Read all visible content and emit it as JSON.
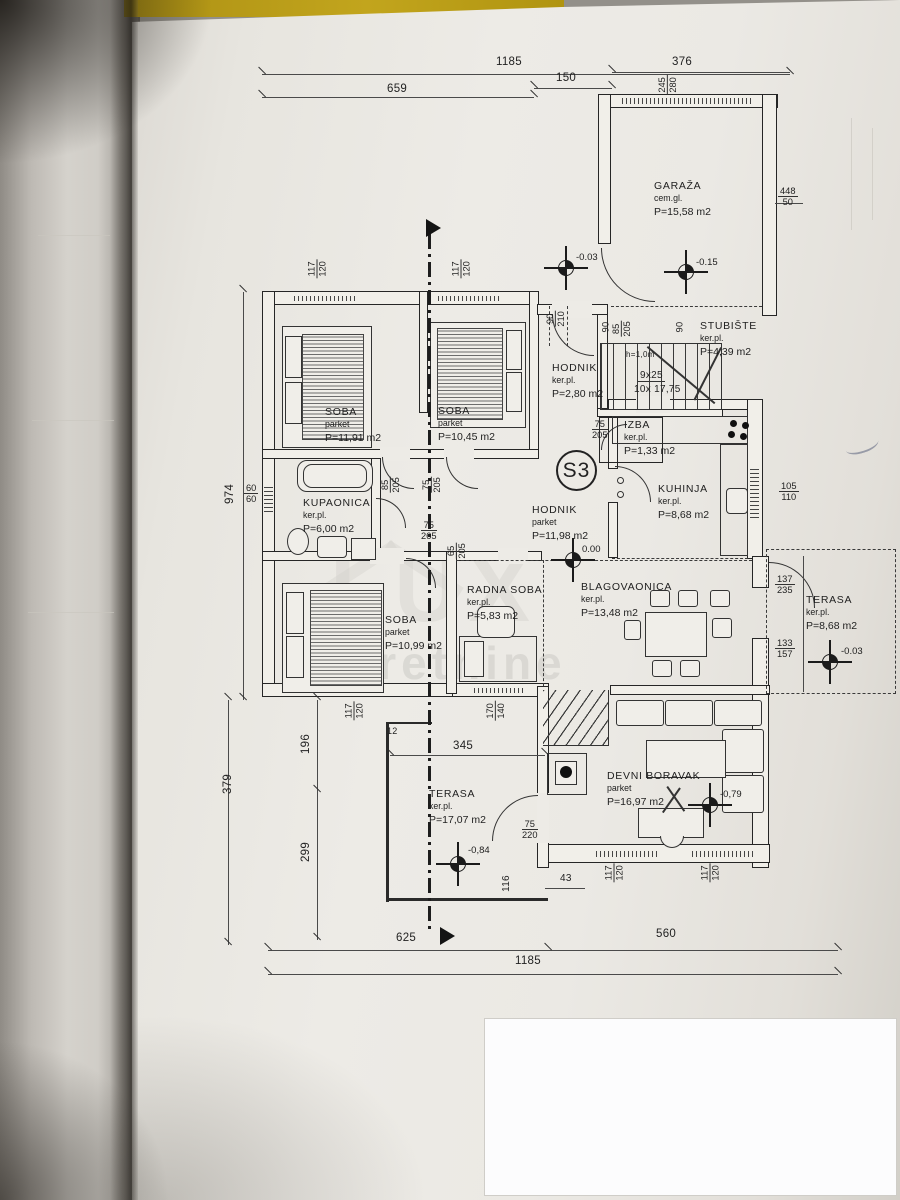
{
  "watermark": {
    "logo": "LUX",
    "text": "nekretnine"
  },
  "section_label": "S3",
  "stairs": {
    "height_note": "h=1,0m",
    "count1": "9x25",
    "count2": "10x 17,75"
  },
  "rooms": [
    {
      "name": "SOBA",
      "floor": "parket",
      "area": "P=11,91 m2"
    },
    {
      "name": "SOBA",
      "floor": "parket",
      "area": "P=10,45 m2"
    },
    {
      "name": "HODNIK",
      "floor": "ker.pl.",
      "area": "P=2,80 m2"
    },
    {
      "name": "STUBIŠTE",
      "floor": "ker.pl.",
      "area": "P=4,39 m2"
    },
    {
      "name": "GARAŽA",
      "floor": "cem.gl.",
      "area": "P=15,58 m2"
    },
    {
      "name": "IZBA",
      "floor": "ker.pl.",
      "area": "P=1,33 m2"
    },
    {
      "name": "KUPAONICA",
      "floor": "ker.pl.",
      "area": "P=6,00 m2"
    },
    {
      "name": "KUHINJA",
      "floor": "ker.pl.",
      "area": "P=8,68 m2"
    },
    {
      "name": "HODNIK",
      "floor": "parket",
      "area": "P=11,98 m2"
    },
    {
      "name": "RADNA SOBA",
      "floor": "ker.pl.",
      "area": "P=5,83 m2"
    },
    {
      "name": "BLAGOVAONICA",
      "floor": "ker.pl.",
      "area": "P=13,48 m2"
    },
    {
      "name": "SOBA",
      "floor": "parket",
      "area": "P=10,99 m2"
    },
    {
      "name": "TERASA",
      "floor": "ker.pl.",
      "area": "P=8,68 m2"
    },
    {
      "name": "TERASA",
      "floor": "ker.pl.",
      "area": "P=17,07 m2"
    },
    {
      "name": "DEVNI BORAVAK",
      "floor": "parket",
      "area": "P=16,97 m2"
    }
  ],
  "dims": [
    "1185",
    "659",
    "150",
    "376",
    "245",
    "280",
    "448",
    "50",
    "117",
    "120",
    "117",
    "120",
    "90",
    "210",
    "85",
    "205",
    "90",
    "75",
    "205",
    "105",
    "110",
    "60",
    "60",
    "85",
    "205",
    "75",
    "205",
    "75",
    "265",
    "65",
    "205",
    "137",
    "235",
    "133",
    "157",
    "117",
    "120",
    "170",
    "140",
    "12",
    "345",
    "196",
    "379",
    "299",
    "974",
    "75",
    "220",
    "116",
    "43",
    "117",
    "120",
    "117",
    "120",
    "625",
    "560",
    "1185",
    "90"
  ],
  "elevations": [
    "-0.03",
    "-0.15",
    "0.00",
    "-0.03",
    "-0,84",
    "-0,79"
  ]
}
